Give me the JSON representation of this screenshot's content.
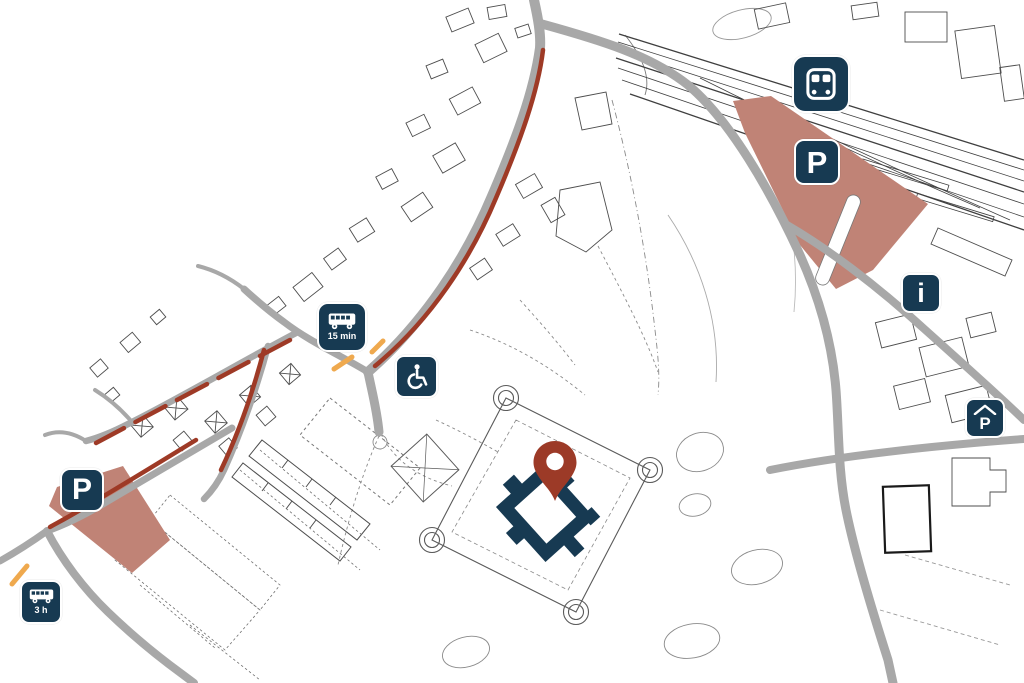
{
  "colors": {
    "marker_navy": "#173a52",
    "route_red": "#9e3a26",
    "parking_area_fill": "#c08376",
    "road_gray": "#a8a8a8",
    "stop_orange": "#efa94e",
    "map_line": "#4d4d4d",
    "pin_red": "#9c3a27",
    "background": "#ffffff"
  },
  "markers": {
    "train_station": {
      "icon": "train-icon"
    },
    "parking_station": {
      "label": "P",
      "icon": "parking-icon"
    },
    "info_point": {
      "label": "i",
      "icon": "info-icon"
    },
    "covered_parking": {
      "label": "P",
      "icon": "covered-parking-icon"
    },
    "bus_stop_north": {
      "label": "15 min",
      "icon": "bus-icon"
    },
    "accessible_entrance": {
      "icon": "wheelchair-icon"
    },
    "parking_west": {
      "label": "P",
      "icon": "parking-icon"
    },
    "bus_stop_west": {
      "label": "3 h",
      "icon": "bus-icon"
    },
    "destination": {
      "icon": "map-pin-icon"
    }
  }
}
